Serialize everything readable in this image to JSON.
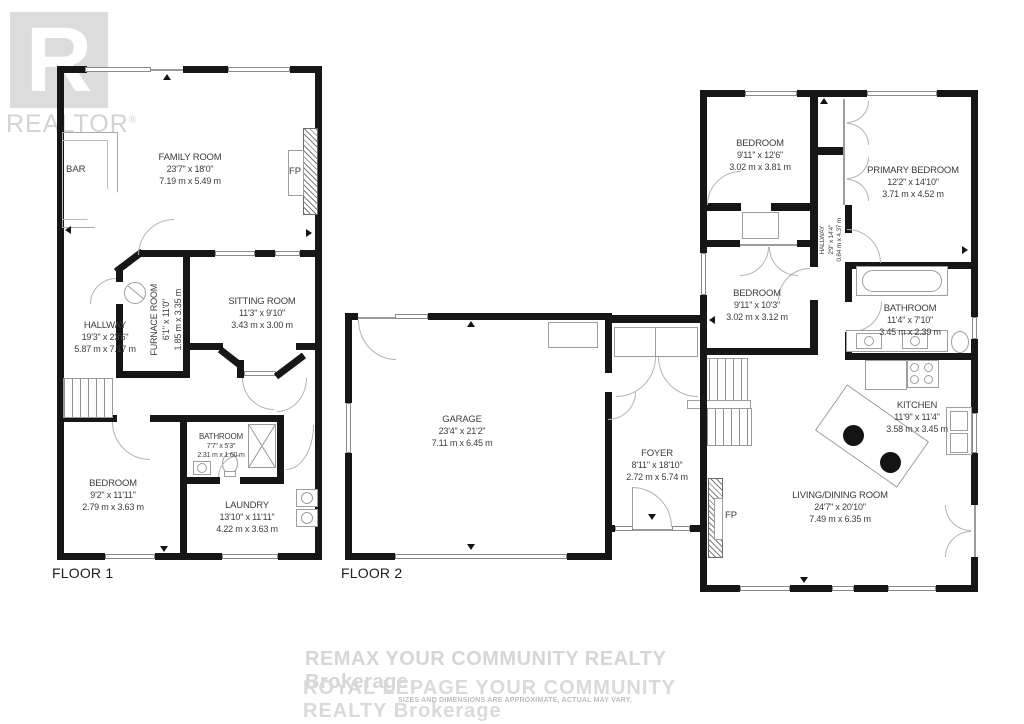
{
  "branding": {
    "realtor_logo": "R",
    "realtor_text": "REALTOR",
    "registered_mark": "®",
    "watermark_line1": "REMAX YOUR COMMUNITY REALTY Brokerage",
    "watermark_line2": "ROYAL LEPAGE YOUR COMMUNITY REALTY  Brokerage",
    "disclaimer": "SIZES AND DIMENSIONS ARE APPROXIMATE, ACTUAL MAY VARY."
  },
  "floor1": {
    "label": "FLOOR 1",
    "rooms": {
      "family_room": {
        "name": "FAMILY ROOM",
        "imperial": "23'7\" x 18'0\"",
        "metric": "7.19 m x 5.49 m"
      },
      "hallway": {
        "name": "HALLWAY",
        "imperial": "19'3\" x 23'6\"",
        "metric": "5.87 m x 7.17 m"
      },
      "furnace_room": {
        "name": "FURNACE ROOM",
        "imperial": "6'1\" x 11'0\"",
        "metric": "1.85 m x 3.35 m"
      },
      "sitting_room": {
        "name": "SITTING ROOM",
        "imperial": "11'3\" x 9'10\"",
        "metric": "3.43 m x 3.00 m"
      },
      "bathroom": {
        "name": "BATHROOM",
        "imperial": "7'7\" x 5'3\"",
        "metric": "2.31 m x 1.60 m"
      },
      "bedroom": {
        "name": "BEDROOM",
        "imperial": "9'2\" x 11'11\"",
        "metric": "2.79 m x 3.63 m"
      },
      "laundry": {
        "name": "LAUNDRY",
        "imperial": "13'10\" x 11'11\"",
        "metric": "4.22 m x 3.63 m"
      }
    },
    "fixtures": {
      "bar": "BAR",
      "fireplace": "FP"
    }
  },
  "floor2": {
    "label": "FLOOR 2",
    "rooms": {
      "garage": {
        "name": "GARAGE",
        "imperial": "23'4\" x 21'2\"",
        "metric": "7.11 m x 6.45 m"
      },
      "foyer": {
        "name": "FOYER",
        "imperial": "8'11\" x 18'10\"",
        "metric": "2.72 m x 5.74 m"
      },
      "bedroom_top": {
        "name": "BEDROOM",
        "imperial": "9'11\" x 12'6\"",
        "metric": "3.02 m x 3.81 m"
      },
      "primary_bedroom": {
        "name": "PRIMARY BEDROOM",
        "imperial": "12'2\" x 14'10\"",
        "metric": "3.71 m x 4.52 m"
      },
      "hallway": {
        "name": "HALLWAY",
        "imperial": "2'9\" x 14'4\"",
        "metric": "0.84 m x 4.37 m"
      },
      "bedroom_mid": {
        "name": "BEDROOM",
        "imperial": "9'11\" x 10'3\"",
        "metric": "3.02 m x 3.12 m"
      },
      "bathroom": {
        "name": "BATHROOM",
        "imperial": "11'4\" x 7'10\"",
        "metric": "3.45 m x 2.39 m"
      },
      "kitchen": {
        "name": "KITCHEN",
        "imperial": "11'9\" x 11'4\"",
        "metric": "3.58 m x 3.45 m"
      },
      "living_dining": {
        "name": "LIVING/DINING ROOM",
        "imperial": "24'7\" x 20'10\"",
        "metric": "7.49 m x 6.35 m"
      }
    },
    "fixtures": {
      "fireplace": "FP"
    }
  }
}
